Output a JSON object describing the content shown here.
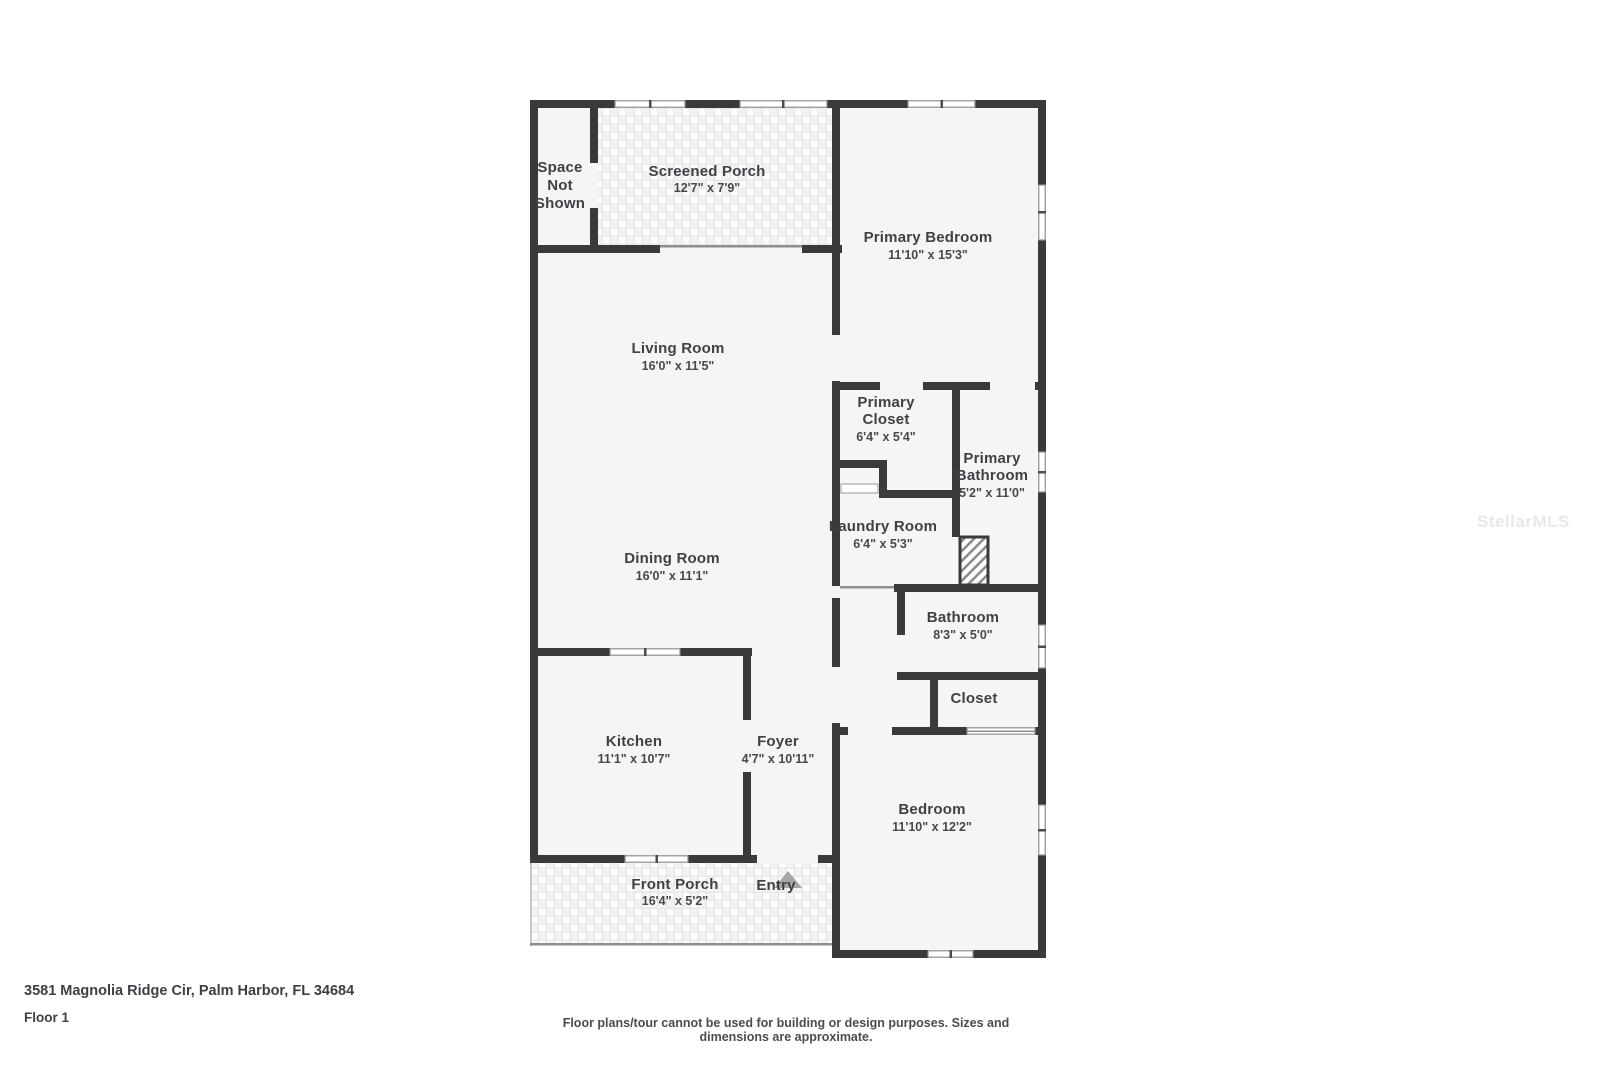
{
  "meta": {
    "address": "3581 Magnolia Ridge Cir, Palm Harbor, FL 34684",
    "floor": "Floor 1",
    "disclaimer": "Floor plans/tour cannot be used for building or design purposes. Sizes and dimensions are approximate.",
    "watermark": "StellarMLS"
  },
  "colors": {
    "wall": "#3a3a3c",
    "floor": "#f5f5f5",
    "label": "#3f4145",
    "porch_tile_bg": "#e8e8e8",
    "entry_arrow": "#a6a6a6",
    "watermark": "#e8e8ea"
  },
  "rooms": {
    "space_not_shown": {
      "lines": [
        "Space",
        "Not",
        "Shown"
      ]
    },
    "screened_porch": {
      "name": "Screened Porch",
      "dims": "12'7\" x 7'9\""
    },
    "primary_bedroom": {
      "name": "Primary Bedroom",
      "dims": "11'10\" x 15'3\""
    },
    "living_room": {
      "name": "Living Room",
      "dims": "16'0\" x 11'5\""
    },
    "dining_room": {
      "name": "Dining Room",
      "dims": "16'0\" x 11'1\""
    },
    "primary_closet": {
      "lines": [
        "Primary",
        "Closet"
      ],
      "dims": "6'4\" x 5'4\""
    },
    "primary_bathroom": {
      "lines": [
        "Primary",
        "Bathroom"
      ],
      "dims": "5'2\" x 11'0\""
    },
    "laundry_room": {
      "name": "Laundry Room",
      "dims": "6'4\" x 5'3\""
    },
    "bathroom": {
      "name": "Bathroom",
      "dims": "8'3\" x 5'0\""
    },
    "closet": {
      "name": "Closet"
    },
    "kitchen": {
      "name": "Kitchen",
      "dims": "11'1\" x 10'7\""
    },
    "foyer": {
      "name": "Foyer",
      "dims": "4'7\" x 10'11\""
    },
    "bedroom": {
      "name": "Bedroom",
      "dims": "11'10\" x 12'2\""
    },
    "front_porch": {
      "name": "Front Porch",
      "dims": "16'4\" x 5'2\""
    },
    "entry": {
      "name": "Entry"
    }
  }
}
